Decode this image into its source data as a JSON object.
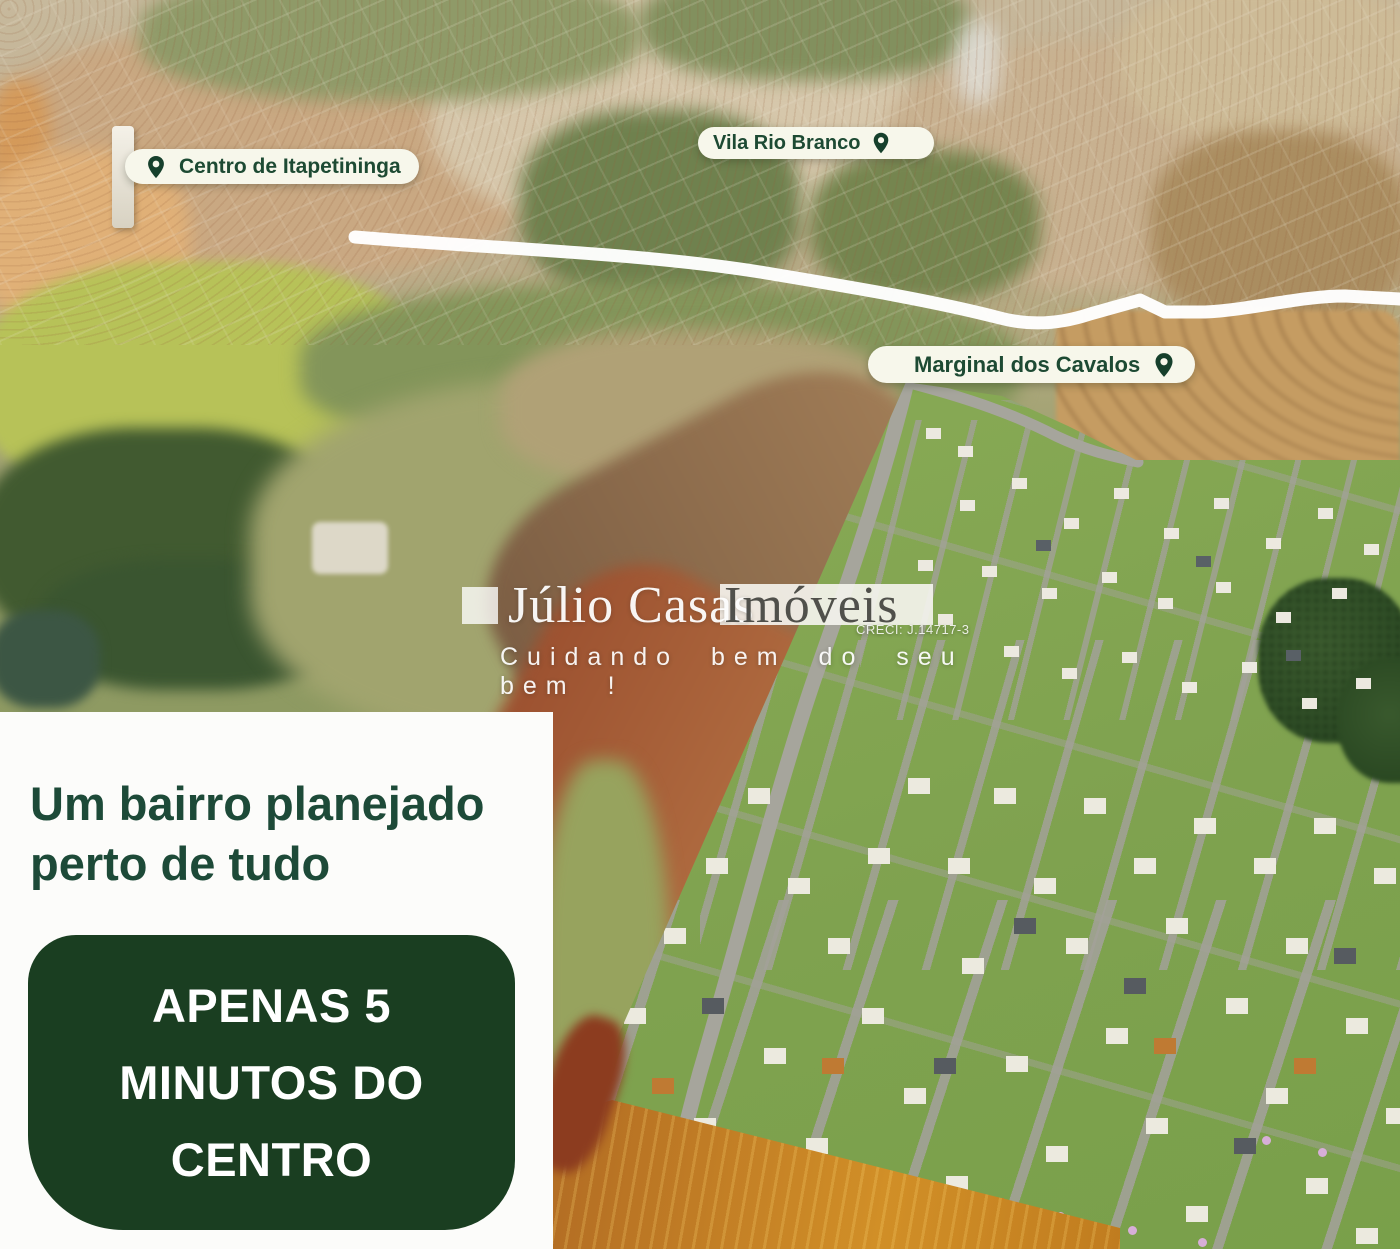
{
  "map_pins": [
    {
      "label": "Centro de Itapetininga",
      "icon": "location-pin-icon"
    },
    {
      "label": "Vila Rio Branco",
      "icon": "location-pin-icon"
    },
    {
      "label": "Marginal dos Cavalos",
      "icon": "location-pin-icon"
    }
  ],
  "watermark": {
    "brand_name": "Júlio Casas",
    "brand_suffix": "Imóveis",
    "creci": "CRECI: J.14717-3",
    "tagline": "Cuidando bem do seu bem !"
  },
  "panel": {
    "headline_line1": "Um bairro planejado",
    "headline_line2": "perto de tudo",
    "badge_line1": "APENAS 5",
    "badge_line2": "MINUTOS DO",
    "badge_line3": "CENTRO"
  },
  "colors": {
    "brand_green": "#1d4a38",
    "badge_green": "#1a3e21",
    "pill_cream": "#f7f7eb",
    "pin_green": "#16402c"
  }
}
